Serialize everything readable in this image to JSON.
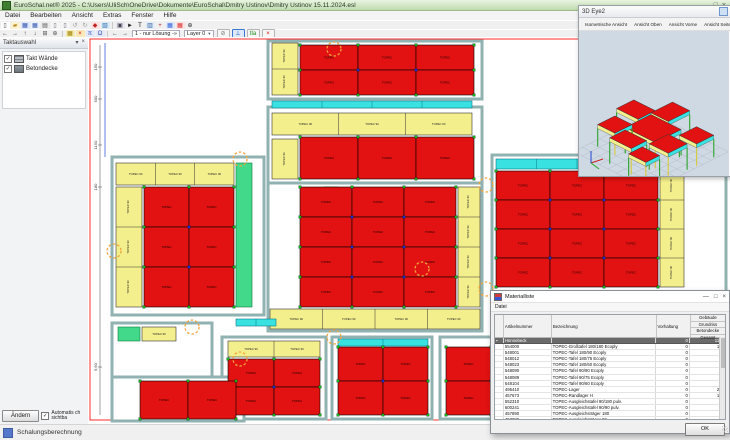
{
  "window": {
    "title": "EuroSchal.net® 2025 - C:\\Users\\UliSch\\OneDrive\\Dokumente\\EuroSchal\\Dmitry Ustinov\\Dmitry Ustinov 15.11.2024.esl",
    "controls": {
      "minimize": "—",
      "maximize": "□",
      "close": "×"
    }
  },
  "menu": {
    "items": [
      "Datei",
      "Bearbeiten",
      "Ansicht",
      "Extras",
      "Fenster",
      "Hilfe"
    ]
  },
  "toolbars": {
    "row1": [
      {
        "name": "new-icon",
        "glyph": "▯",
        "fg": "#444",
        "bg": "#fff"
      },
      {
        "name": "open-icon",
        "glyph": "▰",
        "fg": "#b58a1f",
        "bg": "#fdf3d0"
      },
      {
        "name": "save-icon",
        "glyph": "▦",
        "fg": "#2d4fae",
        "bg": "#dfe7fa"
      },
      {
        "name": "save-all-icon",
        "glyph": "▦",
        "fg": "#2d4fae",
        "bg": "#eef2fc"
      },
      {
        "name": "print-icon",
        "glyph": "▤",
        "fg": "#555",
        "bg": "#ececec"
      },
      {
        "name": "copy-icon",
        "glyph": "▯",
        "fg": "#667",
        "bg": "#f6f6f6"
      },
      {
        "name": "page-icon",
        "glyph": "▯",
        "fg": "#667",
        "bg": "#f6f6f6"
      },
      {
        "name": "undo-icon",
        "glyph": "↺",
        "fg": "#9a9a9a",
        "bg": "transparent"
      },
      {
        "name": "redo-icon",
        "glyph": "↻",
        "fg": "#9a9a9a",
        "bg": "transparent"
      },
      {
        "name": "paint-icon",
        "glyph": "◆",
        "fg": "#c22424",
        "bg": "#fbe3e3"
      },
      {
        "name": "image-icon",
        "glyph": "▧",
        "fg": "#2d6fae",
        "bg": "#ddebf7"
      },
      {
        "name": "sep",
        "glyph": "",
        "fg": "",
        "bg": ""
      },
      {
        "name": "camera-icon",
        "glyph": "▣",
        "fg": "#445",
        "bg": "#e8e8ee"
      },
      {
        "name": "pointer-icon",
        "glyph": "►",
        "fg": "#222",
        "bg": "transparent"
      },
      {
        "name": "text-tool-icon",
        "glyph": "T",
        "fg": "#111",
        "bg": "transparent"
      },
      {
        "name": "columns-icon",
        "glyph": "▥",
        "fg": "#2d5f9e",
        "bg": "#e3edf8"
      },
      {
        "name": "add-icon",
        "glyph": "+",
        "fg": "#b03030",
        "bg": "transparent"
      },
      {
        "name": "table-blue-icon",
        "glyph": "▦",
        "fg": "#2b5fd9",
        "bg": "#e0e9fb"
      },
      {
        "name": "table-red-icon",
        "glyph": "▦",
        "fg": "#d92b2b",
        "bg": "#fbe0e0"
      },
      {
        "name": "zoom-icon",
        "glyph": "⊕",
        "fg": "#333",
        "bg": "transparent"
      }
    ],
    "row2_nav": [
      {
        "name": "pan-left-icon",
        "glyph": "←",
        "fg": "#333"
      },
      {
        "name": "pan-right-icon",
        "glyph": "→",
        "fg": "#333"
      },
      {
        "name": "pan-up-icon",
        "glyph": "↑",
        "fg": "#333"
      },
      {
        "name": "pan-down-icon",
        "glyph": "↓",
        "fg": "#333"
      },
      {
        "name": "grid-zoom-icon",
        "glyph": "⊞",
        "fg": "#555"
      },
      {
        "name": "magnifier-icon",
        "glyph": "⊕",
        "fg": "#555"
      }
    ],
    "row2_colored": [
      {
        "name": "deck-panel-icon",
        "glyph": "▦",
        "fg": "#9a7d00",
        "bg": "#f7ecb0"
      },
      {
        "name": "delete-panel-icon",
        "glyph": "×",
        "fg": "#cc1111",
        "bg": "#fde9b8"
      },
      {
        "name": "props-icon",
        "glyph": "π",
        "fg": "#2d4fae",
        "bg": "#e3e9f8"
      },
      {
        "name": "stairs-icon",
        "glyph": "Ω",
        "fg": "#2d4fae",
        "bg": "#e3e9f8"
      }
    ],
    "solution_nav": {
      "prev": "←",
      "next": "→",
      "label": "1 - nur Lösung -»"
    },
    "layer": {
      "label": "Layer 0",
      "caret": "▾"
    },
    "row2_right": [
      {
        "name": "no-snap-button",
        "glyph": "⊘",
        "fg": "#777",
        "active": false
      },
      {
        "name": "ortho-button",
        "glyph": "⊥",
        "fg": "#1d4fb0",
        "active": true
      },
      {
        "name": "dim-toggle-button",
        "glyph": "tla",
        "fg": "#1a8a1a",
        "active": false
      },
      {
        "name": "abort-button",
        "glyph": "×",
        "fg": "#cc1111",
        "active": false
      }
    ]
  },
  "taktauswahl": {
    "title": "Taktauswahl",
    "pin": "▾",
    "close": "×",
    "items": [
      {
        "label": "Takt Wände",
        "icon": "wall-icon",
        "checked": "✓"
      },
      {
        "label": "Betondecke",
        "icon": "slab-icon",
        "checked": "✓"
      }
    ],
    "change_button": "Ändern",
    "auto_checkbox": {
      "checked": "✓",
      "label": "Automatis ch sichtba"
    }
  },
  "statusbar": {
    "text": "Schalungsberechnung"
  },
  "viewer3d": {
    "title": "3D Eye2",
    "corner_button": "cube",
    "buttons": [
      "Isometrische Ansicht",
      "Ansicht Oben",
      "Ansicht Vorne",
      "Ansicht Seite"
    ],
    "scene": {
      "bg": "#cfd9e4",
      "grid": "#b4bdc8",
      "slab_top": "#e31212",
      "slab_edge": "#f4ef8d",
      "slab_side": "#3ae1e1",
      "leg": "#2aa52a",
      "leg2": "#d8c93a",
      "slabs": [
        [
          0.5,
          2.5,
          2.5,
          2,
          26
        ],
        [
          3,
          0.5,
          2,
          2.5,
          26
        ],
        [
          3.2,
          3.2,
          3.5,
          3,
          26
        ],
        [
          6.8,
          1.5,
          2,
          2,
          22
        ],
        [
          0.8,
          5,
          2,
          2,
          22
        ],
        [
          3.5,
          6.5,
          2.5,
          1.8,
          26
        ],
        [
          6.5,
          4.5,
          2.2,
          2.2,
          26
        ],
        [
          6,
          7,
          2,
          1.6,
          22
        ]
      ],
      "axis": {
        "x": "#cc2222",
        "y": "#22aa22",
        "z": "#2244cc"
      }
    }
  },
  "material_dialog": {
    "title": "Materialliste",
    "controls": {
      "minimize": "—",
      "maximize": "□",
      "close": "×"
    },
    "menu": "Datei",
    "columns": {
      "artikel": "Artikelnummer",
      "bezeichnung": "Bezeichnung",
      "vorhaltung": "Vorhaltung",
      "stacked": [
        "Gebäude",
        "Grundriss",
        "Betondecke",
        "Gesamt"
      ]
    },
    "group_row": {
      "marker": "▪",
      "label": "Hünnebeck",
      "vorhaltung": "0",
      "gesamt": "1195"
    },
    "rows": [
      [
        "554000",
        "TOPEC-Großtafel 180/180 Ecoply",
        "0",
        "121"
      ],
      [
        "548001",
        "TOPEC-Tafel 180/90 Ecoply",
        "0",
        "73"
      ],
      [
        "548012",
        "TOPEC-Tafel 180/75 Ecoply",
        "0",
        "2"
      ],
      [
        "548023",
        "TOPEC-Tafel 180/60 Ecoply",
        "0",
        "5"
      ],
      [
        "548090",
        "TOPEC-Tafel 90/90 Ecoply",
        "0",
        "9"
      ],
      [
        "548089",
        "TOPEC-Tafel 90/75 Ecoply",
        "0",
        "2"
      ],
      [
        "548104",
        "TOPEC-Tafel 90/60 Ecoply",
        "0",
        "1"
      ],
      [
        "495410",
        "TOPEC-Lager",
        "0",
        "236"
      ],
      [
        "457673",
        "TOPEC-Randlager H",
        "0",
        "178"
      ],
      [
        "552310",
        "TOPEC-Ausgleichstafel 90/180 pulv.",
        "0",
        "29"
      ],
      [
        "600241",
        "TOPEC-Ausgleichstafel 90/90 pulv.",
        "0",
        "6"
      ],
      [
        "457890",
        "TOPEC-Ausgleichsträger 180",
        "0",
        "86"
      ],
      [
        "457880",
        "TOPEC-Ausgleichsträger 90",
        "0",
        "24"
      ],
      [
        "601440",
        "EUROPLUS new 30 - 300",
        "0",
        "414"
      ],
      [
        "492006",
        "TOPEC-Querträger 90",
        "0",
        "9"
      ]
    ],
    "ok": "OK"
  },
  "plan": {
    "colors": {
      "red": "#e31212",
      "yellow": "#f4ef8d",
      "cyan": "#3ae1e1",
      "green": "#43d98b",
      "wall": "#90b2b0",
      "node_inner": "#2026d8",
      "node_outer": "#17b417",
      "marker": "#f0a43c",
      "frame": "#ff2a2a",
      "dim": "#444",
      "blue_line": "#3a5fd9"
    },
    "sheet_frame": [
      2,
      2,
      636,
      381
    ],
    "rooms": [
      [
        180,
        4,
        214,
        58
      ],
      [
        180,
        70,
        214,
        76
      ],
      [
        180,
        146,
        214,
        148
      ],
      [
        24,
        120,
        152,
        158
      ],
      [
        24,
        286,
        100,
        58
      ],
      [
        134,
        300,
        104,
        82
      ],
      [
        244,
        300,
        100,
        82
      ],
      [
        352,
        300,
        100,
        82
      ],
      [
        404,
        118,
        234,
        140
      ],
      [
        404,
        264,
        234,
        118
      ],
      [
        24,
        340,
        132,
        44
      ]
    ],
    "red_grids": [
      [
        212,
        8,
        3,
        2,
        58,
        25
      ],
      [
        212,
        100,
        3,
        1,
        58,
        42
      ],
      [
        212,
        150,
        3,
        4,
        52,
        30
      ],
      [
        56,
        150,
        2,
        3,
        45,
        40
      ],
      [
        140,
        322,
        2,
        2,
        46,
        28
      ],
      [
        250,
        310,
        2,
        2,
        45,
        34
      ],
      [
        358,
        310,
        2,
        2,
        45,
        34
      ],
      [
        408,
        134,
        3,
        4,
        54,
        29
      ],
      [
        408,
        296,
        3,
        3,
        54,
        28
      ],
      [
        52,
        344,
        2,
        1,
        48,
        38
      ]
    ],
    "yellow_strips": [
      [
        184,
        6,
        26,
        52,
        "v",
        2
      ],
      [
        184,
        76,
        200,
        22,
        "h",
        3
      ],
      [
        184,
        102,
        26,
        40,
        "v",
        1
      ],
      [
        370,
        150,
        22,
        120,
        "v",
        4
      ],
      [
        182,
        272,
        210,
        20,
        "h",
        4
      ],
      [
        28,
        126,
        118,
        22,
        "h",
        3
      ],
      [
        28,
        150,
        26,
        120,
        "v",
        3
      ],
      [
        54,
        290,
        34,
        14,
        "h",
        1
      ],
      [
        140,
        304,
        92,
        16,
        "h",
        2
      ],
      [
        572,
        134,
        24,
        116,
        "v",
        4
      ],
      [
        408,
        276,
        188,
        18,
        "h",
        4
      ]
    ],
    "cyan_strips": [
      [
        184,
        64,
        200,
        7
      ],
      [
        250,
        302,
        90,
        7
      ],
      [
        408,
        122,
        162,
        10
      ],
      [
        408,
        266,
        188,
        8
      ],
      [
        148,
        282,
        40,
        7
      ]
    ],
    "green_strips": [
      [
        148,
        126,
        16,
        144
      ],
      [
        30,
        290,
        22,
        14
      ],
      [
        236,
        150,
        14,
        60
      ]
    ],
    "markers": [
      [
        246,
        12
      ],
      [
        152,
        122
      ],
      [
        26,
        214
      ],
      [
        104,
        290
      ],
      [
        152,
        322
      ],
      [
        246,
        300
      ],
      [
        334,
        232
      ],
      [
        398,
        148
      ],
      [
        398,
        252
      ],
      [
        584,
        120
      ]
    ],
    "marker_r": 7,
    "dim": {
      "x": 12,
      "y1": 8,
      "y2": 378,
      "labels": [
        [
          30,
          "150"
        ],
        [
          62,
          "500"
        ],
        [
          108,
          "1150"
        ],
        [
          150,
          "180"
        ],
        [
          330,
          "9,60"
        ]
      ],
      "blue_line": [
        17,
        6,
        17,
        120
      ]
    },
    "red_label": "TOPEC",
    "yellow_label": "TOPEC 90"
  }
}
